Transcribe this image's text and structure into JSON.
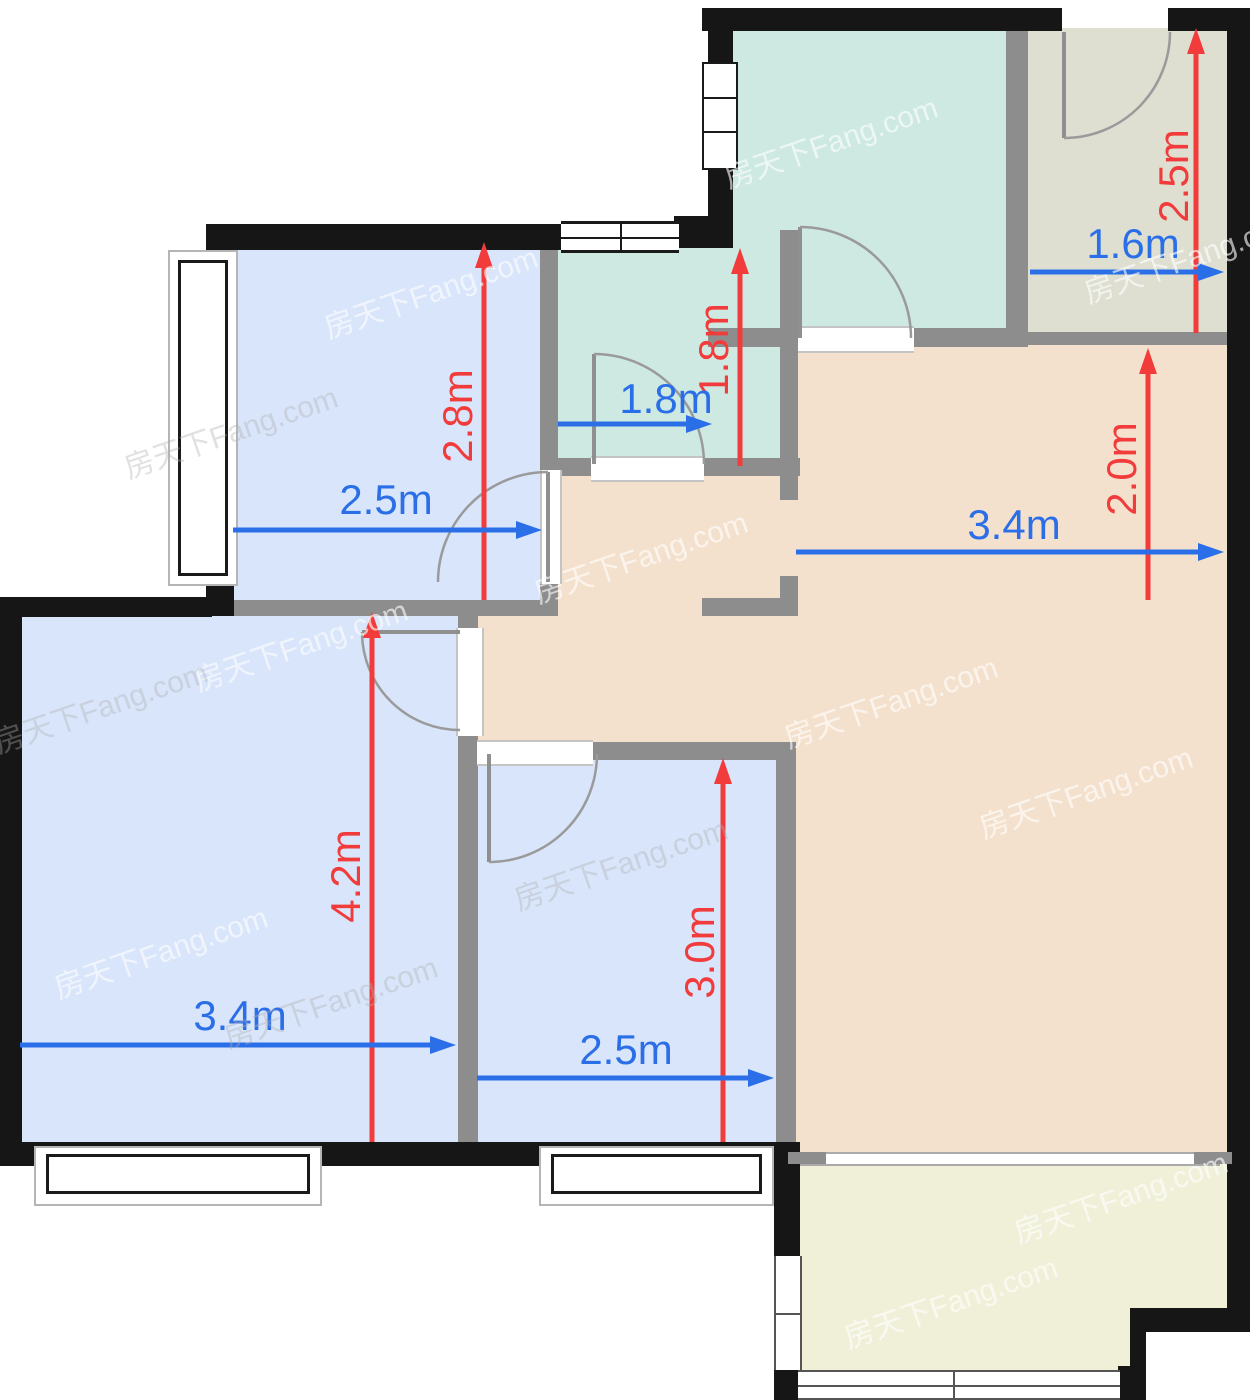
{
  "watermark": {
    "text": "房天下Fang.com"
  },
  "colors": {
    "dim_red": "#F23B3B",
    "dim_blue": "#2B6FE8",
    "room_blue": "#D8E5FA",
    "room_teal": "#CDE9E1",
    "room_khaki": "#DEDFD1",
    "room_tan": "#F4E1CD",
    "room_balcony": "#F0F0D9",
    "wall_black": "#161616",
    "wall_gray": "#8D8D8D",
    "window_frame": "#1a1a1a",
    "bay_frame": "#b5b5b5"
  },
  "dimensions": [
    {
      "value": "2.8m",
      "axis": "vertical",
      "color": "red"
    },
    {
      "value": "1.8m",
      "axis": "vertical",
      "color": "red"
    },
    {
      "value": "2.5m",
      "axis": "vertical",
      "color": "red"
    },
    {
      "value": "2.0m",
      "axis": "vertical",
      "color": "red"
    },
    {
      "value": "4.2m",
      "axis": "vertical",
      "color": "red"
    },
    {
      "value": "3.0m",
      "axis": "vertical",
      "color": "red"
    },
    {
      "value": "2.5m",
      "axis": "horizontal",
      "color": "blue"
    },
    {
      "value": "1.8m",
      "axis": "horizontal",
      "color": "blue"
    },
    {
      "value": "1.6m",
      "axis": "horizontal",
      "color": "blue"
    },
    {
      "value": "3.4m",
      "axis": "horizontal",
      "color": "blue"
    },
    {
      "value": "3.4m",
      "axis": "horizontal",
      "color": "blue"
    },
    {
      "value": "2.5m",
      "axis": "horizontal",
      "color": "blue"
    }
  ]
}
